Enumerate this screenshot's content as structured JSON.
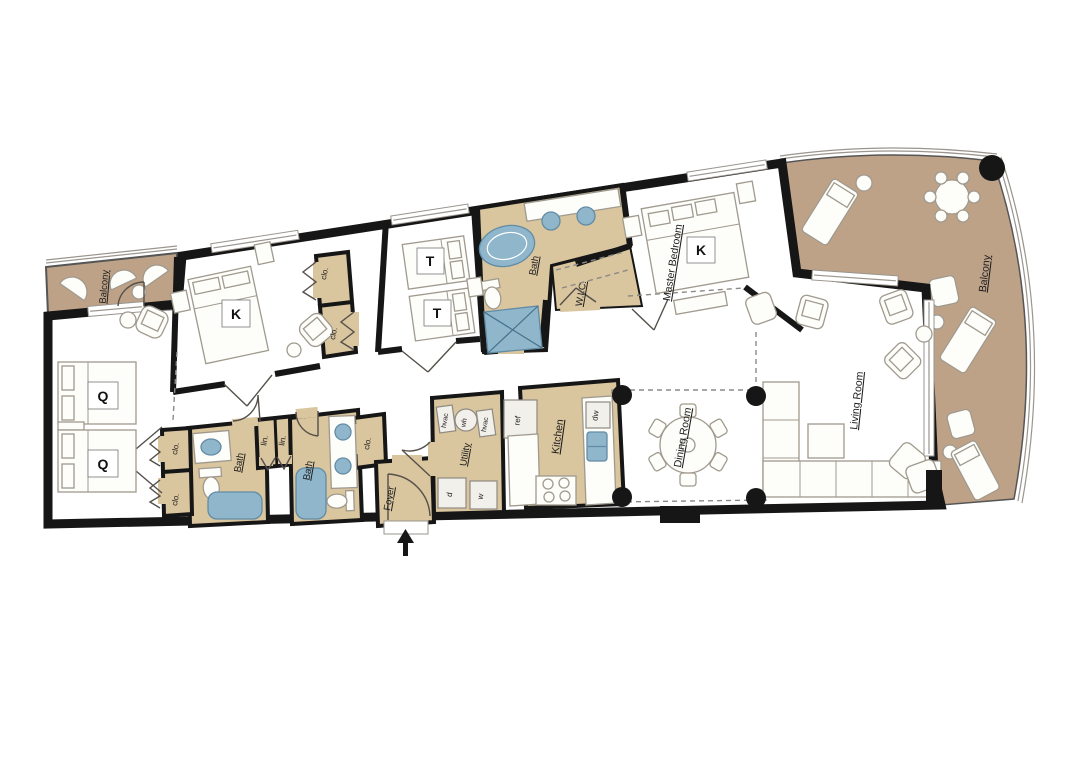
{
  "plan_type": "condominium floor plan",
  "colors": {
    "wall": "#161616",
    "floor": "#ebe4d8",
    "tile": "#d9c59e",
    "balcony": "#bea288",
    "fixture_blue": "#8fb6cb",
    "furniture": "#fdfdfa"
  },
  "rooms": [
    {
      "id": "balcony-left",
      "label": "Balcony"
    },
    {
      "id": "bedroom-queen",
      "beds": [
        "Q",
        "Q"
      ]
    },
    {
      "id": "bedroom-king",
      "beds": [
        "K"
      ]
    },
    {
      "id": "bedroom-twin",
      "beds": [
        "T",
        "T"
      ]
    },
    {
      "id": "master-bedroom",
      "label": "Master Bedroom",
      "beds": [
        "K"
      ]
    },
    {
      "id": "master-bath",
      "label": "Bath"
    },
    {
      "id": "walk-in-closet",
      "label": "W.I.C."
    },
    {
      "id": "bath-1",
      "label": "Bath"
    },
    {
      "id": "bath-2",
      "label": "Bath"
    },
    {
      "id": "utility",
      "label": "Utility",
      "equipment": {
        "hvac": "hvac",
        "water_heater": "wh",
        "dryer": "d",
        "washer": "w"
      }
    },
    {
      "id": "foyer",
      "label": "Foyer"
    },
    {
      "id": "kitchen",
      "label": "Kitchen",
      "equipment": {
        "refrigerator": "ref",
        "dishwasher": "dw"
      }
    },
    {
      "id": "dining-room",
      "label": "Dining Room"
    },
    {
      "id": "living-room",
      "label": "Living Room"
    },
    {
      "id": "balcony-right",
      "label": "Balcony"
    },
    {
      "id": "closet",
      "label": "clo."
    },
    {
      "id": "linen-closet",
      "label": "lin."
    }
  ]
}
